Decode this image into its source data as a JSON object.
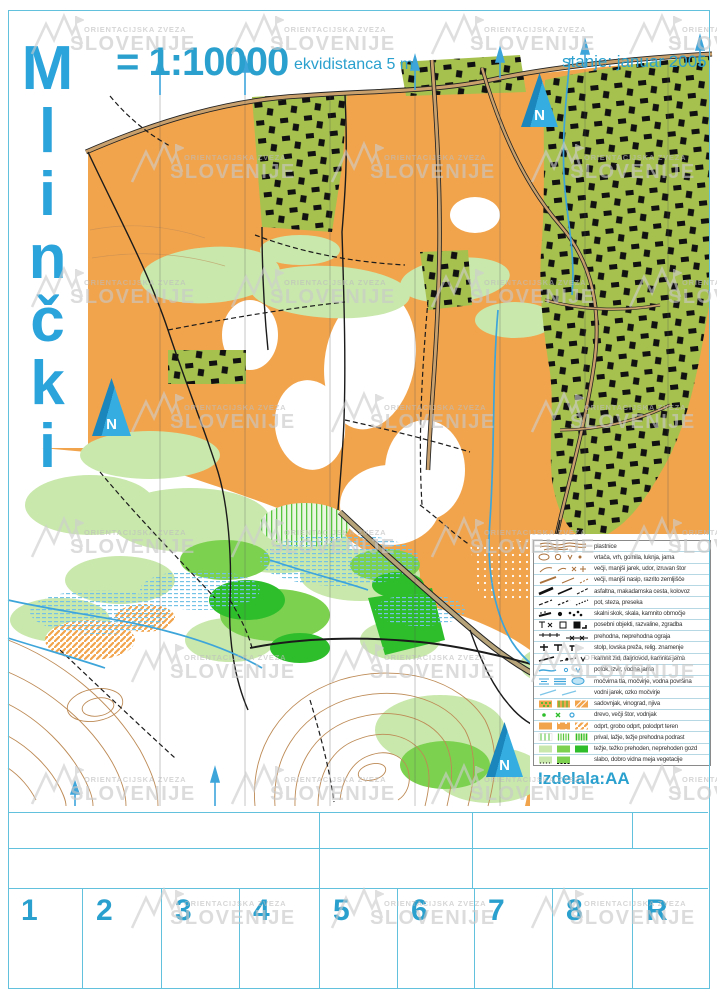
{
  "header": {
    "title": "Mlinčki",
    "scale": "= 1:10000",
    "equidistance": "ekvidistanca 5 m",
    "status": "stanje: januar 2005"
  },
  "map": {
    "north_label": "N"
  },
  "watermark": {
    "org_line1": "ORIENTACIJSKA ZVEZA",
    "org_line2": "SLOVENIJE"
  },
  "legend": {
    "items": [
      {
        "label": "plastnice"
      },
      {
        "label": "vrtača, vrh, gomila, luknja, jama"
      },
      {
        "label": "večji, manjši jarek, udor, izruvan štor"
      },
      {
        "label": "večji, manjši nasip, razrito zemljišče"
      },
      {
        "label": "asfaltna, makadamska cesta, kolovoz"
      },
      {
        "label": "pot, steza, preseka"
      },
      {
        "label": "skalni skok, skala, kamnito območje"
      },
      {
        "label": "posebni objekti, razvaline, zgradba"
      },
      {
        "label": "prehodna, neprehodna ograja"
      },
      {
        "label": "stolp, lovska preža, relig. znamenje"
      },
      {
        "label": "kamnit zid, daljnovod, kamnita jama"
      },
      {
        "label": "potok, izvir, vodna jama"
      },
      {
        "label": "močvirna tla, močvirje, vodna površina"
      },
      {
        "label": "vodni jarek, ozko močvirje"
      },
      {
        "label": "sadovnjak, vinograd, njiva"
      },
      {
        "label": "drevo, večji štor, vodnjak"
      },
      {
        "label": "odprt, grobo odprt, polodprt teren"
      },
      {
        "label": "prival, lažje, težje prehodna podrast"
      },
      {
        "label": "težje, težko prehoden, neprehoden gozd"
      },
      {
        "label": "slabo, dobro vidna meja vegetacije"
      }
    ]
  },
  "footer": {
    "credit": "Izdelala:AA"
  },
  "control_card": {
    "cells": [
      "1",
      "2",
      "3",
      "4",
      "5",
      "6",
      "7",
      "8",
      "R"
    ]
  },
  "colors": {
    "accent_blue": "#2AA0CE",
    "frame_blue": "#62C2DE",
    "map_orange": "#F2A44C",
    "village_green": "#A6C14E",
    "light_green": "#C9E8AC",
    "mid_green": "#7CD24F",
    "dark_green": "#2EBE2C",
    "contour_brown": "#BD8A55",
    "water_blue": "#3EA5DA",
    "watermark_gray": "#C8C8C8"
  }
}
